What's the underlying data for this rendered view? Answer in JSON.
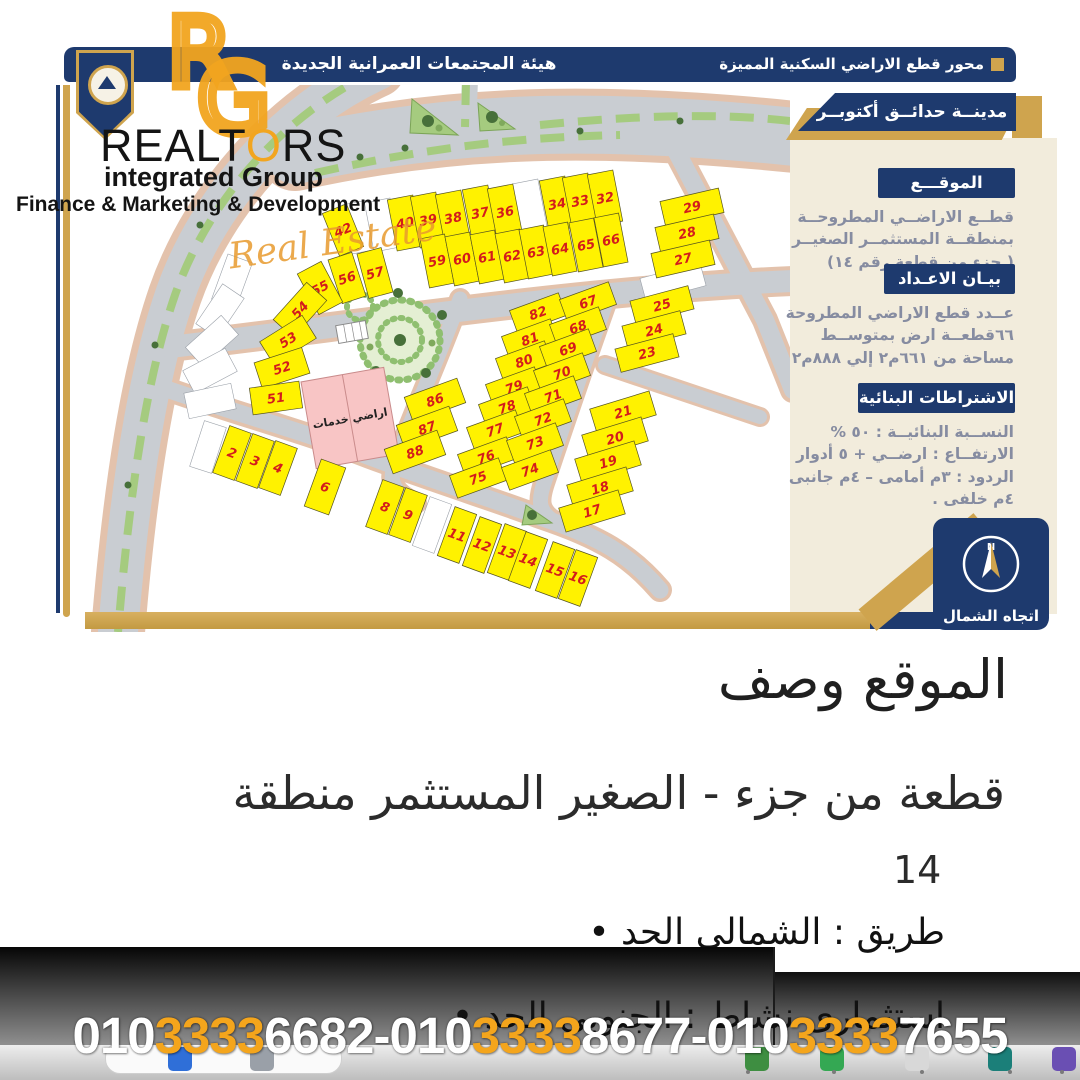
{
  "header": {
    "authority": "هيئة المجتمعات العمرانية الجديدة",
    "axis_title": "محور قطع الاراضي السكنية المميزة"
  },
  "logo": {
    "monogram_r": "R",
    "monogram_g": "G",
    "word_start": "REALT",
    "word_o": "O",
    "word_end": "RS",
    "line2": "integrated Group",
    "line3": "Finance & Marketing & Development",
    "script": "Real Estate"
  },
  "sidebar": {
    "tab": "مدينــة حدائــق أكتوبــر",
    "s1_title": "الموقـــع",
    "s1_l1": "قطــع الاراضــي المطروحــة",
    "s1_l2": "بمنطقــة المستثمــر الصغيــر",
    "s1_l3": "( جزء من قطعة رقم ١٤)",
    "s2_title": "بيـان الاعـداد",
    "s2_l1": "عــدد قطع الاراضي المطروحة",
    "s2_l2": "٦٦قطعــة ارض بمتوســط",
    "s2_l3": "مساحة من ٦٦١م٢ إلي ٨٨٨م٢",
    "s3_title": "الاشتراطات البنائية",
    "s3_l1": "النســبة البنائيــة : ٥٠ %",
    "s3_l2": "الارتفــاع : ارضــي + ٥ أدوار",
    "s3_l3": "الردود : ٣م أمامى – ٤م جانبى",
    "s3_l4": "٤م خلفى ."
  },
  "compass": {
    "label": "اتجاه الشمال",
    "letter": "N"
  },
  "map": {
    "service_label": "اراضي خدمات",
    "plots": [
      [
        40,
        345,
        138,
        26,
        52,
        -11
      ],
      [
        39,
        368,
        135,
        26,
        52,
        -11
      ],
      [
        38,
        393,
        133,
        26,
        52,
        -11
      ],
      [
        37,
        420,
        128,
        26,
        52,
        -11
      ],
      [
        36,
        445,
        127,
        26,
        52,
        -11
      ],
      [
        34,
        497,
        119,
        26,
        52,
        -11
      ],
      [
        33,
        520,
        116,
        26,
        52,
        -11
      ],
      [
        32,
        545,
        113,
        26,
        52,
        -11
      ],
      [
        59,
        377,
        176,
        25,
        50,
        -11
      ],
      [
        60,
        402,
        174,
        25,
        50,
        -11
      ],
      [
        61,
        427,
        172,
        25,
        50,
        -11
      ],
      [
        62,
        452,
        171,
        25,
        50,
        -11
      ],
      [
        63,
        476,
        167,
        25,
        50,
        -11
      ],
      [
        64,
        500,
        164,
        25,
        50,
        -11
      ],
      [
        65,
        526,
        160,
        25,
        50,
        -11
      ],
      [
        66,
        551,
        155,
        25,
        50,
        -11
      ],
      [
        42,
        283,
        145,
        26,
        46,
        -22
      ],
      [
        56,
        287,
        193,
        25,
        46,
        -18
      ],
      [
        57,
        315,
        188,
        25,
        46,
        -15
      ],
      [
        55,
        260,
        203,
        27,
        46,
        -28
      ],
      [
        54,
        240,
        225,
        50,
        27,
        -48
      ],
      [
        53,
        228,
        255,
        50,
        27,
        -32
      ],
      [
        52,
        222,
        283,
        50,
        27,
        -18
      ],
      [
        51,
        216,
        313,
        50,
        27,
        -8
      ],
      [
        29,
        632,
        122,
        60,
        25,
        -13
      ],
      [
        28,
        627,
        148,
        60,
        25,
        -13
      ],
      [
        27,
        623,
        174,
        60,
        25,
        -13
      ],
      [
        25,
        602,
        220,
        60,
        24,
        -15
      ],
      [
        24,
        594,
        245,
        60,
        24,
        -15
      ],
      [
        23,
        587,
        268,
        60,
        24,
        -15
      ],
      [
        21,
        563,
        327,
        62,
        25,
        -17
      ],
      [
        20,
        555,
        353,
        62,
        25,
        -17
      ],
      [
        19,
        548,
        377,
        62,
        25,
        -17
      ],
      [
        18,
        540,
        403,
        62,
        25,
        -17
      ],
      [
        17,
        532,
        426,
        62,
        25,
        -17
      ],
      [
        82,
        478,
        228,
        52,
        24,
        -20
      ],
      [
        81,
        470,
        254,
        52,
        24,
        -20
      ],
      [
        80,
        464,
        276,
        52,
        24,
        -20
      ],
      [
        79,
        454,
        302,
        52,
        24,
        -20
      ],
      [
        78,
        447,
        322,
        52,
        24,
        -20
      ],
      [
        77,
        435,
        345,
        52,
        24,
        -20
      ],
      [
        76,
        426,
        372,
        52,
        24,
        -20
      ],
      [
        75,
        418,
        393,
        52,
        24,
        -20
      ],
      [
        67,
        528,
        217,
        52,
        24,
        -20
      ],
      [
        68,
        518,
        242,
        52,
        24,
        -20
      ],
      [
        69,
        508,
        264,
        52,
        24,
        -20
      ],
      [
        70,
        502,
        288,
        52,
        24,
        -20
      ],
      [
        71,
        493,
        311,
        52,
        24,
        -20
      ],
      [
        72,
        483,
        334,
        52,
        24,
        -20
      ],
      [
        73,
        475,
        358,
        52,
        24,
        -20
      ],
      [
        74,
        470,
        385,
        52,
        24,
        -20
      ],
      [
        86,
        375,
        315,
        56,
        26,
        -20
      ],
      [
        87,
        367,
        343,
        56,
        26,
        -20
      ],
      [
        88,
        355,
        367,
        56,
        26,
        -20
      ],
      [
        2,
        172,
        368,
        23,
        50,
        20
      ],
      [
        3,
        195,
        376,
        23,
        50,
        20
      ],
      [
        4,
        218,
        383,
        23,
        50,
        20
      ],
      [
        6,
        265,
        402,
        26,
        50,
        20
      ],
      [
        8,
        325,
        422,
        23,
        50,
        20
      ],
      [
        9,
        348,
        430,
        23,
        50,
        20
      ],
      [
        11,
        397,
        450,
        23,
        52,
        20
      ],
      [
        12,
        422,
        460,
        23,
        52,
        20
      ],
      [
        13,
        447,
        467,
        23,
        52,
        20
      ],
      [
        14,
        468,
        475,
        23,
        52,
        20
      ],
      [
        15,
        495,
        485,
        23,
        52,
        20
      ],
      [
        16,
        518,
        493,
        23,
        52,
        20
      ]
    ],
    "whites": [
      [
        300,
        142,
        26,
        50,
        -11
      ],
      [
        322,
        140,
        26,
        50,
        -11
      ],
      [
        470,
        122,
        26,
        52,
        -11
      ],
      [
        613,
        197,
        62,
        24,
        -15
      ],
      [
        372,
        440,
        23,
        52,
        20
      ],
      [
        148,
        362,
        23,
        48,
        18
      ],
      [
        172,
        196,
        48,
        26,
        -70
      ],
      [
        160,
        226,
        48,
        26,
        -56
      ],
      [
        152,
        256,
        48,
        26,
        -42
      ],
      [
        150,
        286,
        48,
        26,
        -28
      ],
      [
        150,
        316,
        48,
        26,
        -12
      ]
    ]
  },
  "description": {
    "title": "وصف الموقع",
    "area_line": "منطقة المستثمر الصغير - جزء من قطعة",
    "plot_number": "14",
    "north_bound": "• الحد الشمالى : طريق",
    "south_bound": "• الحد الجنوبى : نشاط استثمارى"
  },
  "phones": {
    "p1_pre": "010",
    "p1_mid": "3333",
    "p1_suf": "6682",
    "sep1": "-",
    "p2_pre": "010",
    "p2_mid": "3333",
    "p2_suf": "8677",
    "sep2": "-",
    "p3_pre": "010",
    "p3_mid": "3333",
    "p3_suf": "7655"
  },
  "colors": {
    "navy": "#1e3a6e",
    "gold": "#cfa44e",
    "cream": "#f2ecdc",
    "plot_yellow": "#fff200",
    "plot_number_red": "#d31c1c",
    "phone_orange": "#f4a51c"
  }
}
